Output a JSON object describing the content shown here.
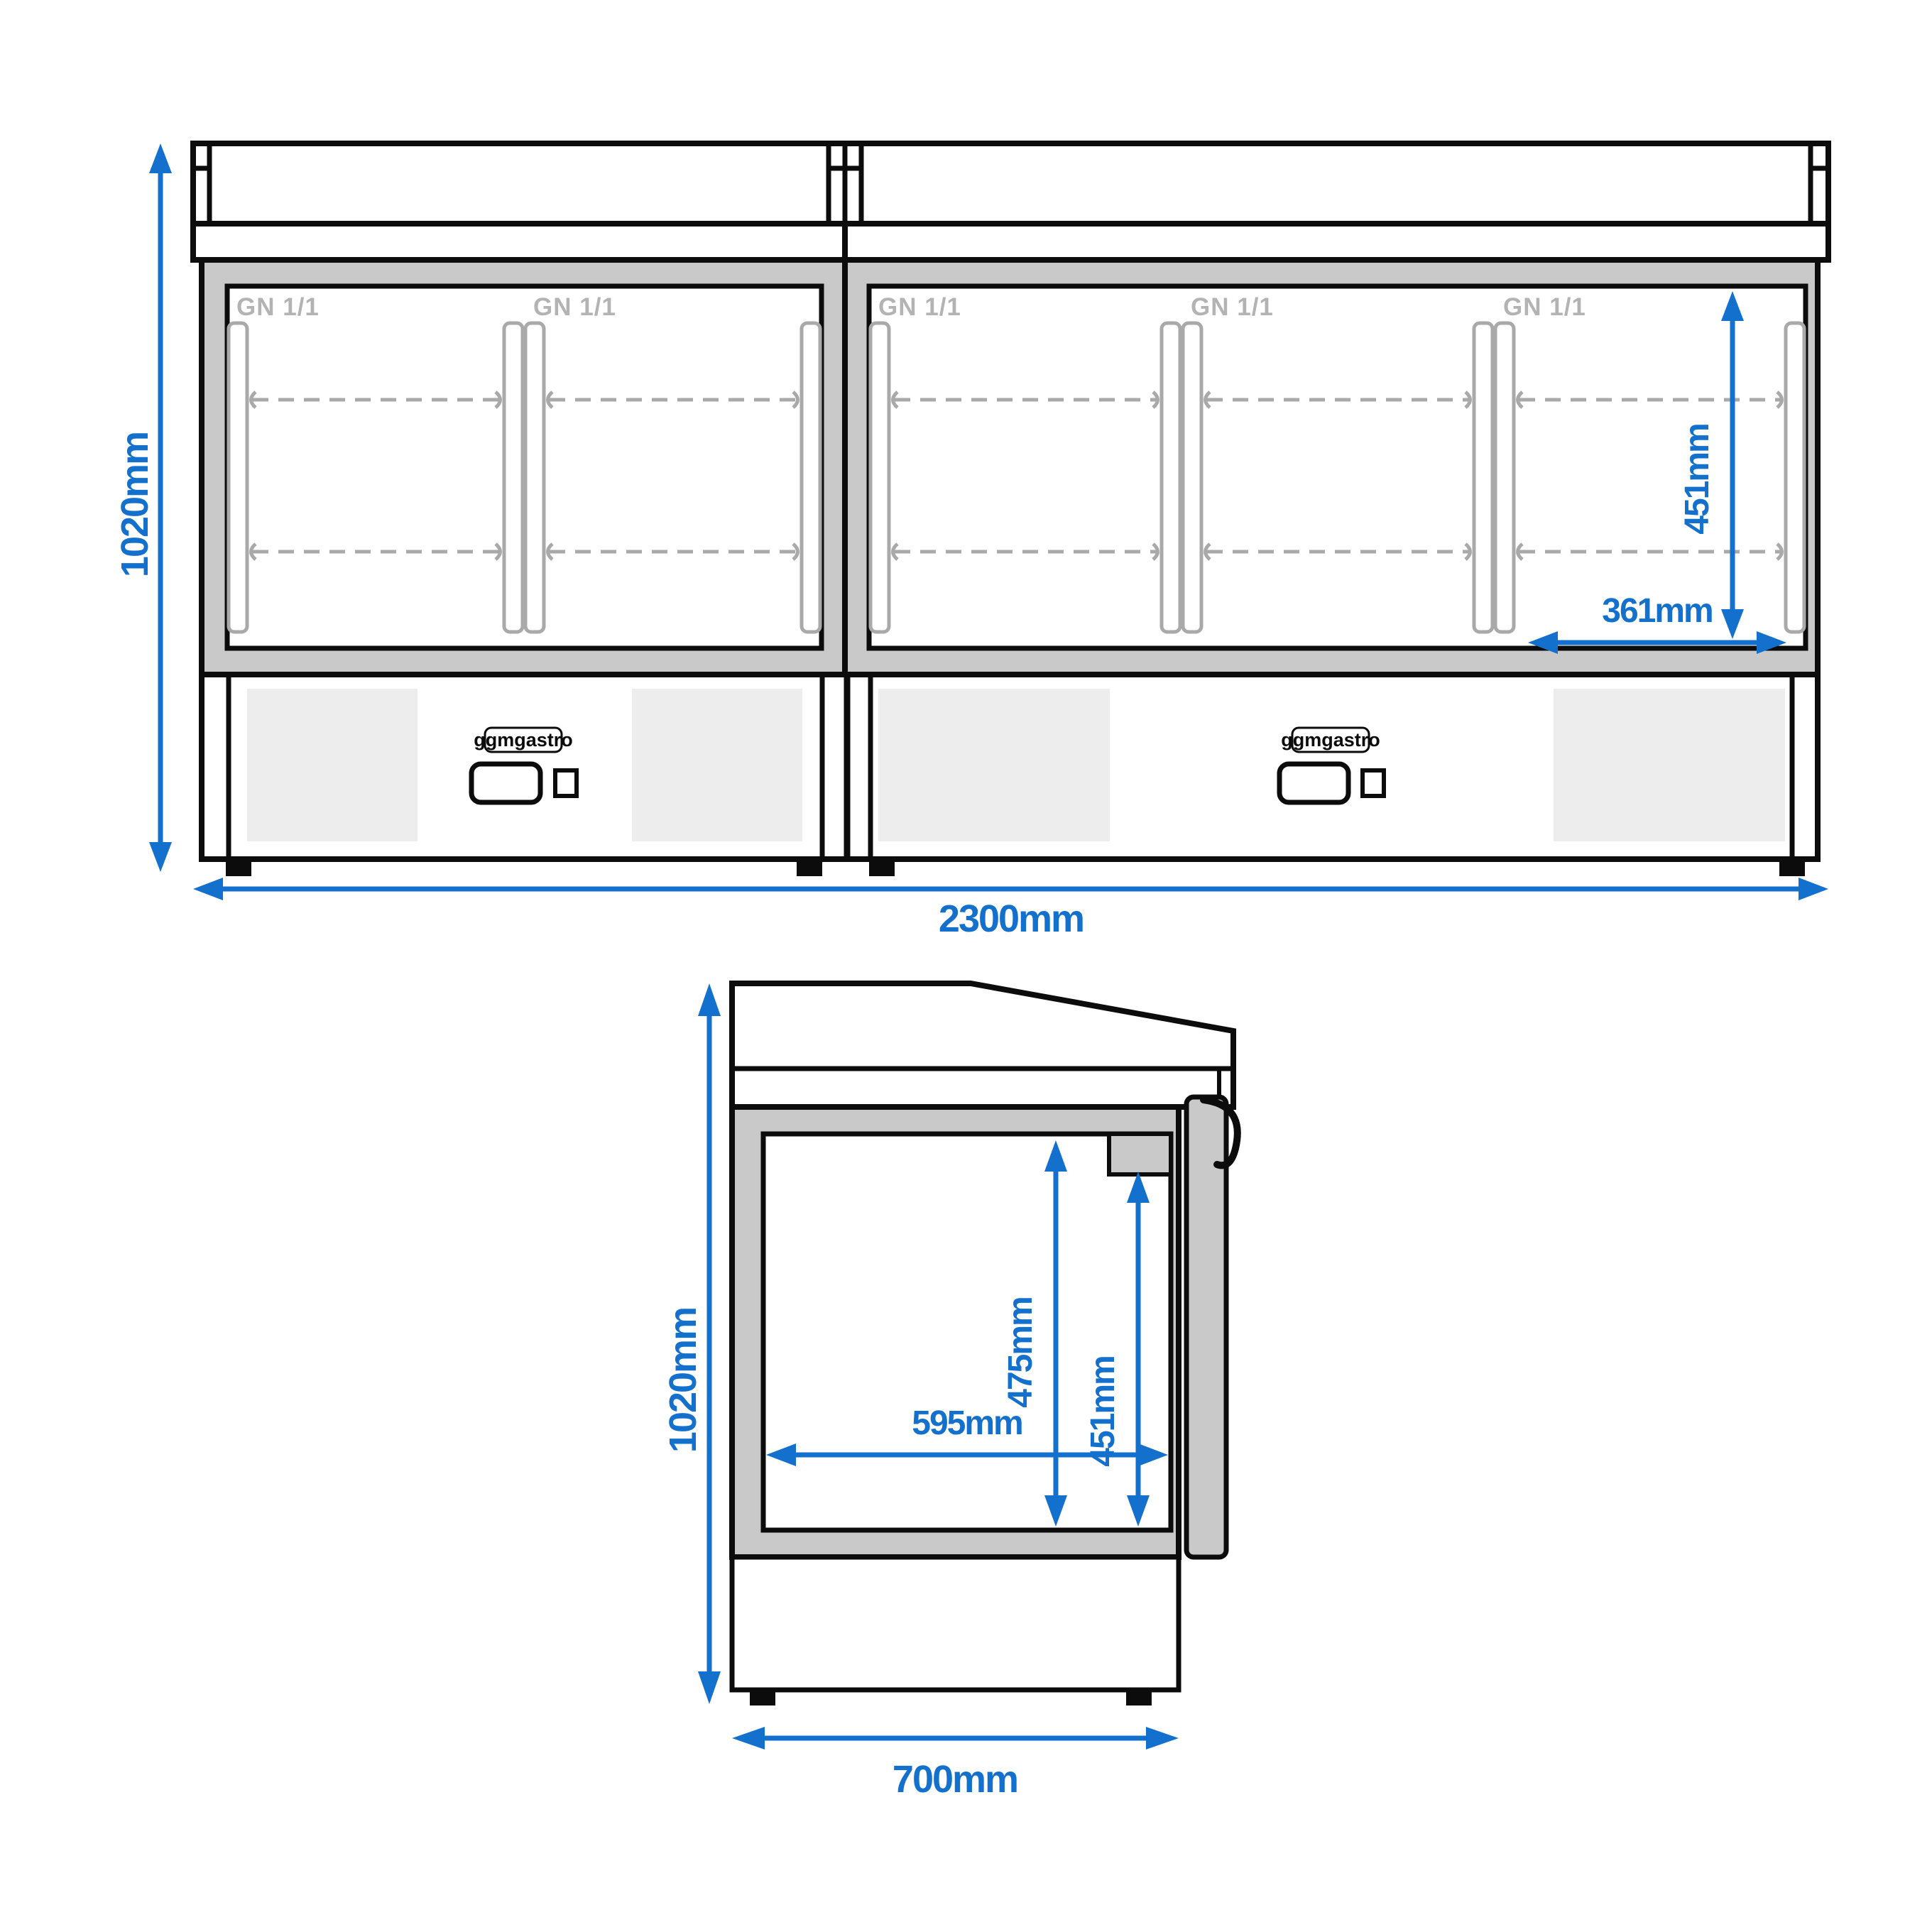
{
  "colors": {
    "blue": "#1470cd",
    "frame-gray": "#c9c9c9",
    "rail-gray": "#a9a9a9",
    "gn-gray": "#b3b3b3",
    "panel-gray": "#ededed",
    "line-black": "#0c0c0c"
  },
  "front_view": {
    "height_label": "1020mm",
    "width_label": "2300mm",
    "inner_height_label": "451mm",
    "inner_width_label": "361mm",
    "door_labels": [
      "GN 1/1",
      "GN 1/1",
      "GN 1/1",
      "GN 1/1",
      "GN 1/1"
    ],
    "units": [
      {
        "brand": "ggmgastro"
      },
      {
        "brand": "ggmgastro"
      }
    ]
  },
  "side_view": {
    "height_label": "1020mm",
    "depth_label": "700mm",
    "inner_depth_label": "595mm",
    "inner_height_label": "475mm",
    "door_height_label": "451mm"
  }
}
